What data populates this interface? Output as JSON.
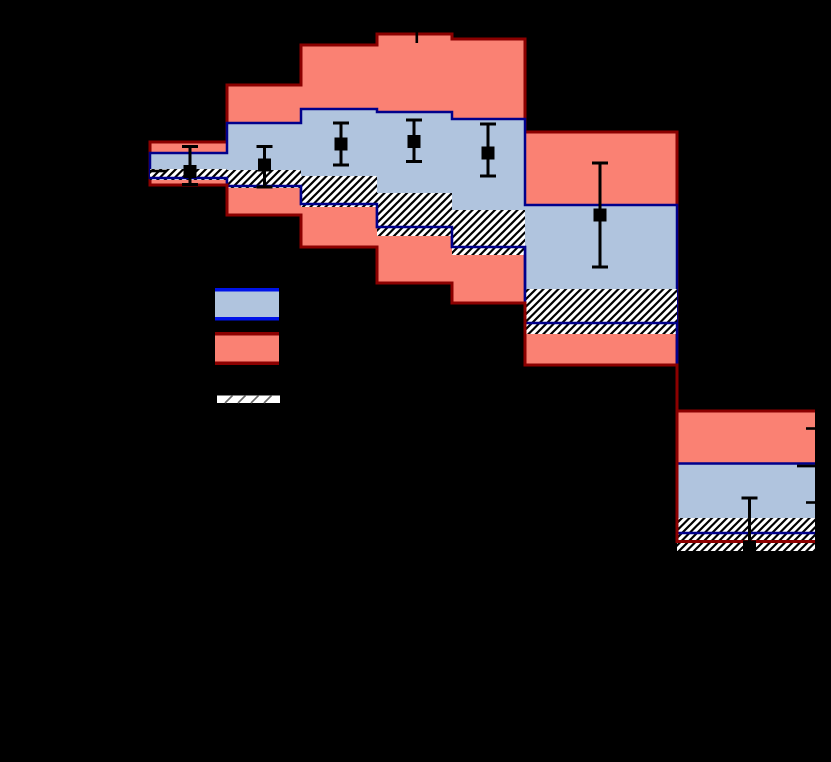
{
  "figure": {
    "width_px": 831,
    "height_px": 762,
    "background": "#000000"
  },
  "chart_data": {
    "type": "area",
    "subtype": "stepped-uncertainty-bands-with-data-points",
    "title": "",
    "axis_note": "all axis labels and legend text are rendered black on black background (not visible); units are pixel coordinates measured from the screenshot",
    "grid": false,
    "axes_px": {
      "left": 150,
      "right": 815,
      "top": 31,
      "clip_left": 147,
      "clip_right": 819
    },
    "colors": {
      "red_fill": "#FA8173",
      "red_edge": "#8B0000",
      "blue_fill": "#B0C4DE",
      "blue_edge": "#00008B",
      "hatch_fill": "#FFFFFF",
      "hatch_line": "#000000",
      "marker": "#000000",
      "tick": "#000000",
      "legend_blue_edge": "#0013E8",
      "legend_slash": "#666666"
    },
    "style": {
      "red_edge_width": 3,
      "blue_edge_width": 2.5,
      "err_line_width": 3,
      "cap_half_width": 8,
      "marker_size": 13,
      "hatch_tile": 7.5,
      "hatch_line_width": 2.2
    },
    "bins": [
      {
        "x0": 150,
        "x1": 227,
        "red": [
          142,
          185
        ],
        "blue": [
          153,
          178
        ],
        "hatch": [
          169,
          180
        ],
        "point": {
          "x": 190,
          "y": 171.5,
          "err_top": 146.5,
          "err_bottom": 184.5,
          "caps": [
            "top",
            "bottom"
          ]
        }
      },
      {
        "x0": 227,
        "x1": 301,
        "red": [
          85,
          215
        ],
        "blue": [
          123,
          186
        ],
        "hatch": [
          170,
          188
        ],
        "point": {
          "x": 264.5,
          "y": 165,
          "err_top": 146.5,
          "err_bottom": 187,
          "caps": [
            "top",
            "bottom"
          ]
        }
      },
      {
        "x0": 301,
        "x1": 377,
        "red": [
          45,
          247
        ],
        "blue": [
          109,
          204
        ],
        "hatch": [
          176,
          207
        ],
        "point": {
          "x": 341,
          "y": 144,
          "err_top": 123,
          "err_bottom": 165,
          "caps": [
            "top",
            "bottom"
          ]
        }
      },
      {
        "x0": 377,
        "x1": 452,
        "red": [
          34,
          283
        ],
        "blue": [
          112,
          227
        ],
        "hatch": [
          193,
          236
        ],
        "point": {
          "x": 414,
          "y": 141.5,
          "err_top": 120,
          "err_bottom": 161.5,
          "caps": [
            "top",
            "bottom"
          ]
        }
      },
      {
        "x0": 452,
        "x1": 525,
        "red": [
          39,
          303
        ],
        "blue": [
          119,
          247
        ],
        "hatch": [
          210,
          255
        ],
        "point": {
          "x": 488,
          "y": 153,
          "err_top": 124,
          "err_bottom": 176,
          "caps": [
            "top",
            "bottom"
          ]
        }
      },
      {
        "x0": 525,
        "x1": 677,
        "red": [
          132,
          365
        ],
        "blue": [
          205,
          323
        ],
        "hatch": [
          289,
          334
        ],
        "point": {
          "x": 600,
          "y": 215,
          "err_top": 163,
          "err_bottom": 267,
          "caps": [
            "top",
            "bottom"
          ]
        }
      },
      {
        "x0": 677,
        "x1": 815,
        "red": [
          411,
          541.5
        ],
        "blue": [
          463.5,
          533
        ],
        "hatch": [
          518,
          551
        ],
        "point": {
          "x": 749.5,
          "y": 547,
          "err_top": 498,
          "err_bottom": 549,
          "caps": [
            "top"
          ]
        }
      }
    ],
    "ticks": [
      {
        "name": "top-major-tick",
        "x1": 416.8,
        "y1": 31,
        "x2": 416.8,
        "y2": 43,
        "w": 2.6
      },
      {
        "name": "left-major-tick",
        "x1": 150,
        "y1": 171,
        "x2": 166,
        "y2": 171,
        "w": 2.6
      },
      {
        "name": "right-minor-tick",
        "x1": 806,
        "y1": 428.5,
        "x2": 815,
        "y2": 428.5,
        "w": 2.6
      },
      {
        "name": "right-major-tick",
        "x1": 797,
        "y1": 466,
        "x2": 815,
        "y2": 466,
        "w": 2.8
      },
      {
        "name": "right-minor-tick",
        "x1": 806,
        "y1": 502.5,
        "x2": 815,
        "y2": 502.5,
        "w": 2.6
      }
    ],
    "legend": {
      "items": [
        {
          "kind": "band",
          "name": "legend-swatch-blue-band",
          "x": 215,
          "y": 288,
          "w": 64,
          "h": 32.5,
          "fill": "#B0C4DE",
          "edge": "#0013E8",
          "edge_w": 3.5
        },
        {
          "kind": "band",
          "name": "legend-swatch-red-band",
          "x": 215,
          "y": 332,
          "w": 64,
          "h": 33,
          "fill": "#FA8173",
          "edge": "#8B0000",
          "edge_w": 3.5
        },
        {
          "kind": "hatch-strip",
          "name": "legend-swatch-hatch-band",
          "x": 217,
          "y": 395.5,
          "w": 63,
          "h": 7.5,
          "fill": "#FFFFFF",
          "slash_offsets": [
            8,
            21,
            34,
            47
          ],
          "slash_w": 1.6
        }
      ]
    }
  }
}
